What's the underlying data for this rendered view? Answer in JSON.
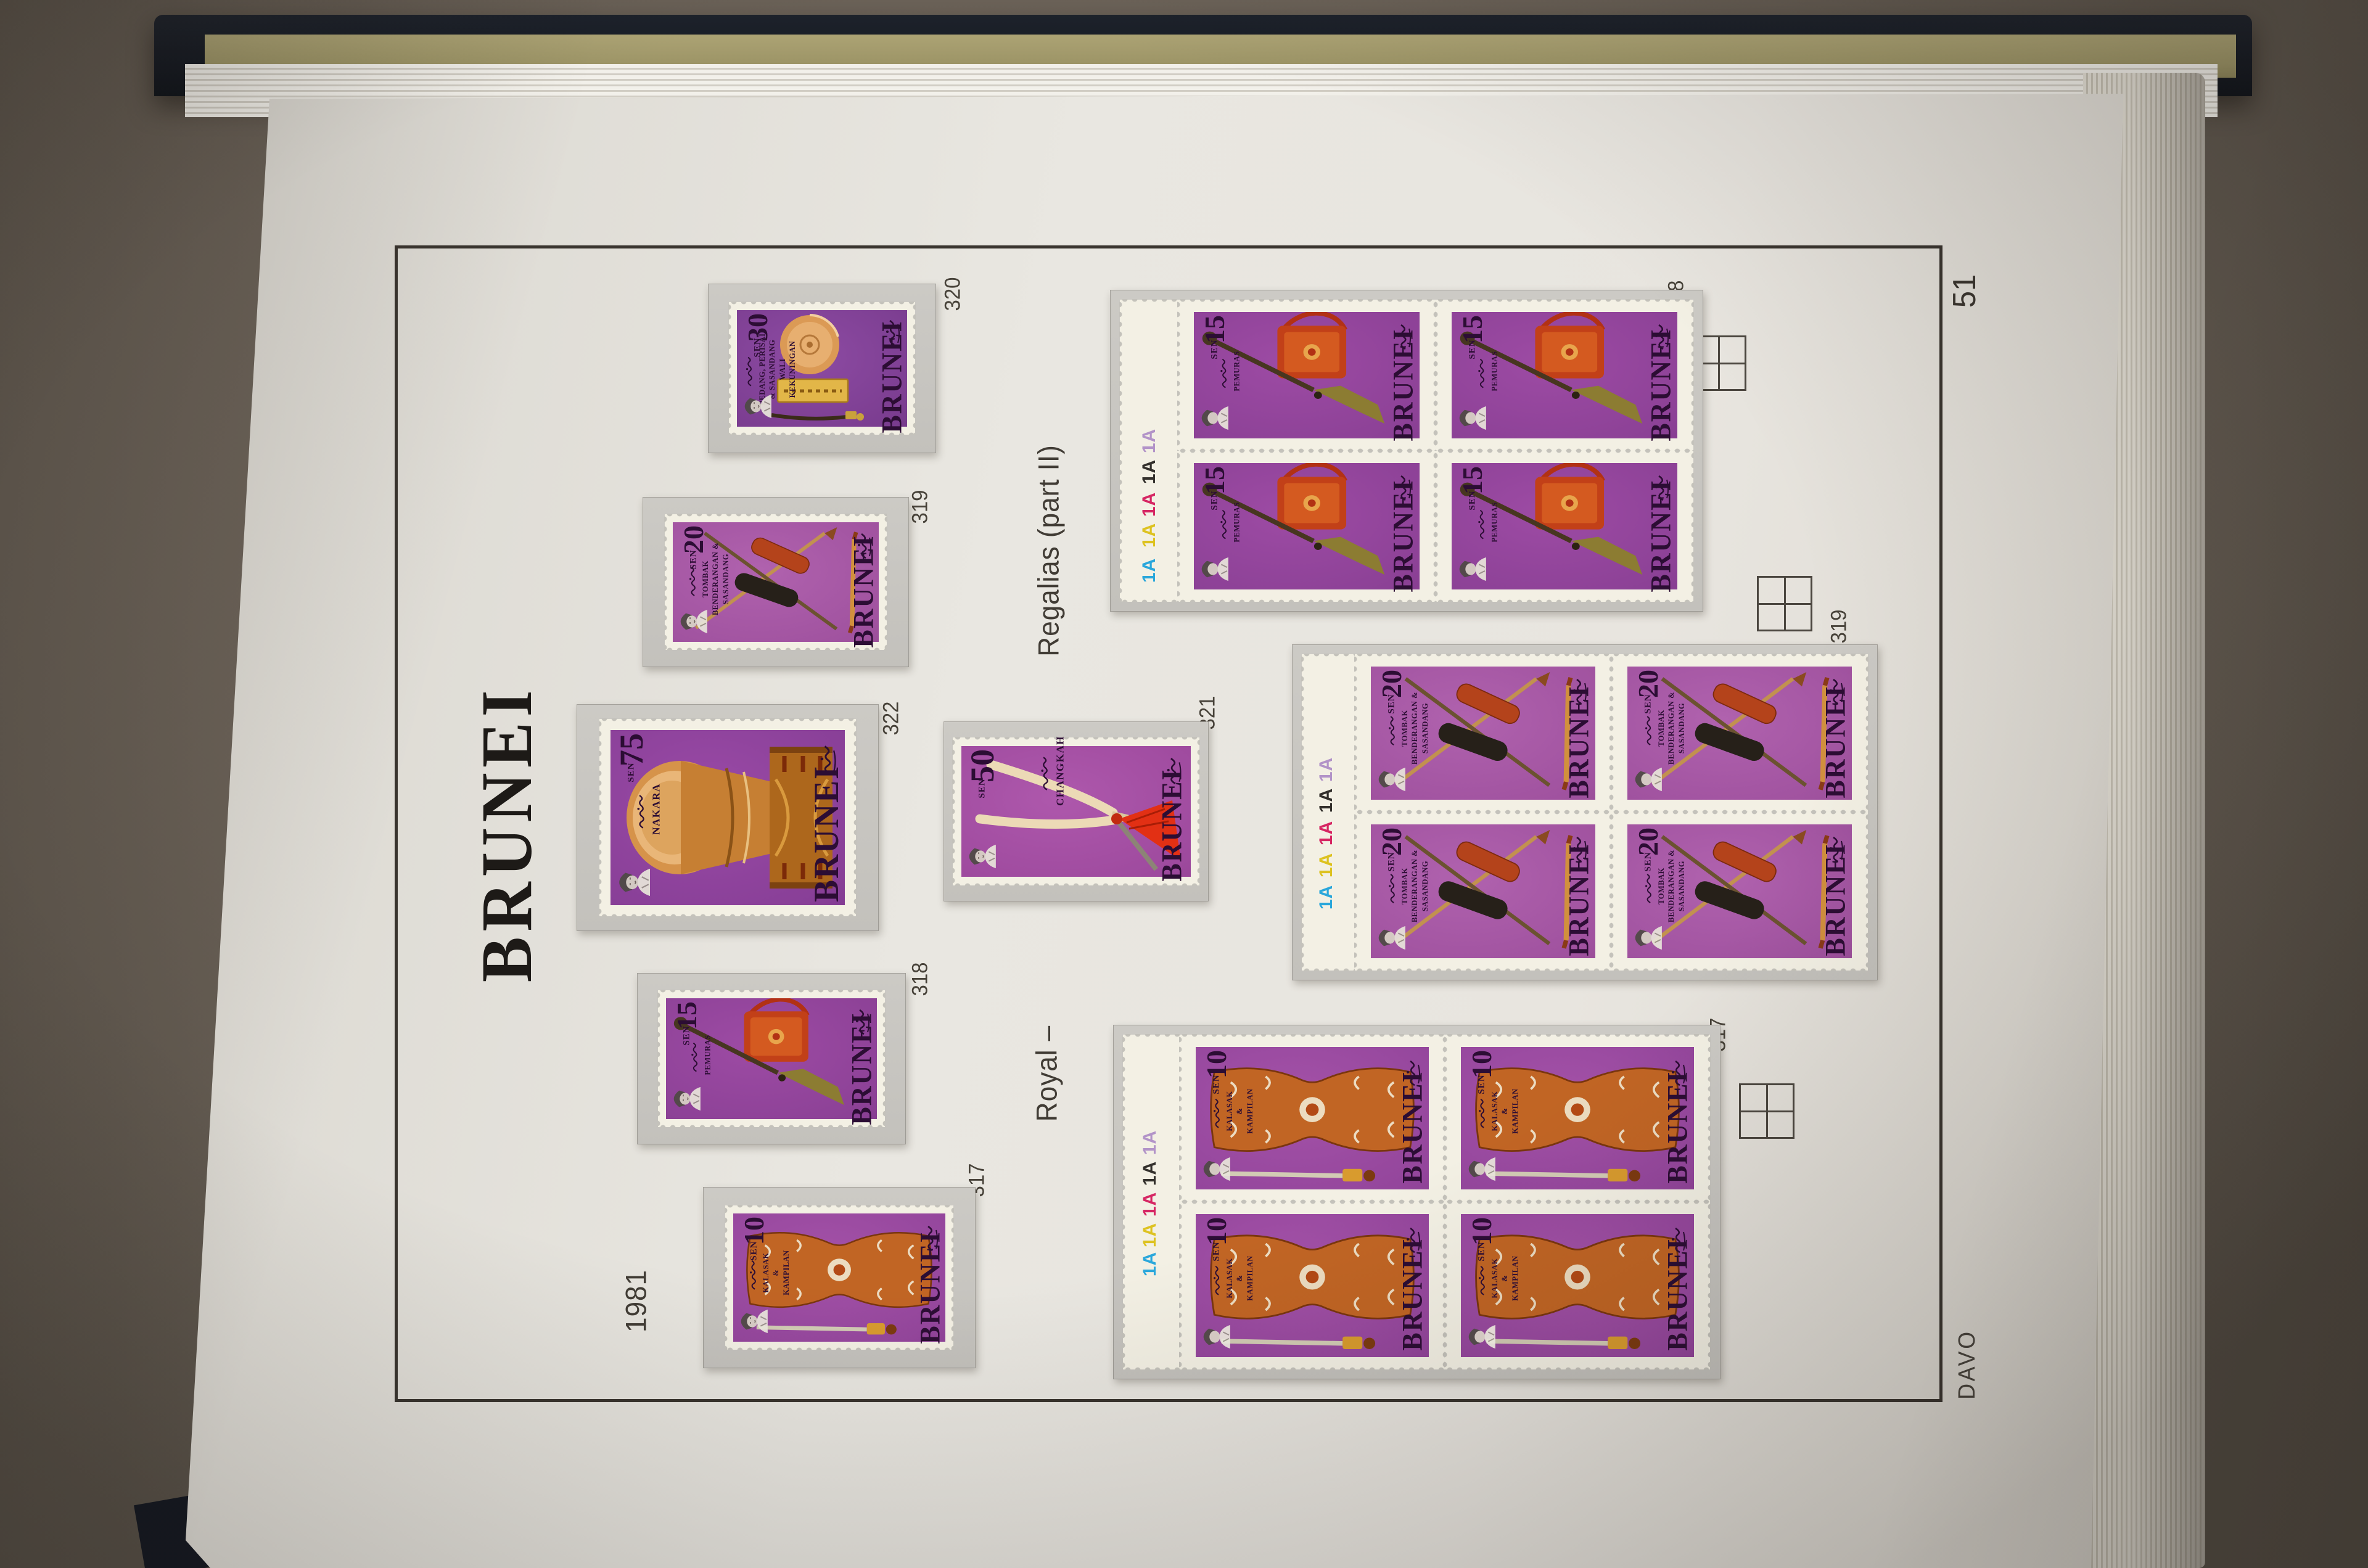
{
  "page": {
    "heading": "BRUNEI",
    "page_number": "51",
    "brand": "DAVO",
    "year": "1981",
    "series_caption_upper": "Regalias (part II)",
    "series_caption_lower": "Royal –"
  },
  "catalog_labels": {
    "s320": "320",
    "s319": "319",
    "s322": "322",
    "s321": "321",
    "s318": "318",
    "s317": "317",
    "b318": "318",
    "b319": "319",
    "b317": "317"
  },
  "stamps": {
    "s320": {
      "value": "30",
      "unit": "SEN",
      "country": "BRUNEI",
      "caption": [
        "PEDANG, PERISAI",
        "& SASANDANG",
        "WALI",
        "KEKUNINGAN"
      ]
    },
    "s319": {
      "value": "20",
      "unit": "SEN",
      "country": "BRUNEI",
      "caption": [
        "TOMBAK",
        "BENDERANGAN &",
        "SASANDANG"
      ]
    },
    "s322": {
      "value": "75",
      "unit": "SEN",
      "country": "BRUNEI",
      "caption": [
        "NAKARA"
      ]
    },
    "s321": {
      "value": "50",
      "unit": "SEN",
      "country": "BRUNEI",
      "caption": [
        "CHANGKAH"
      ]
    },
    "s318": {
      "value": "15",
      "unit": "SEN",
      "country": "BRUNEI",
      "caption": [
        "PEMURAS"
      ]
    },
    "s317": {
      "value": "10",
      "unit": "SEN",
      "country": "BRUNEI",
      "caption": [
        "KALASAK",
        "&",
        "KAMPILAN"
      ]
    }
  },
  "plate_marks": {
    "text": "1A",
    "colors": {
      "lilac": "#b293c8",
      "black": "#33302c",
      "magenta": "#d62663",
      "yellow": "#ddc220",
      "cyan": "#2aa7db"
    }
  },
  "colors": {
    "desk": "#6a6157",
    "album_cover": "#171b22",
    "divider_card": "#a29a6a",
    "page_paper": "#e9e6e0",
    "mount_gray": "#c7c5c0",
    "frame_line": "#39342e",
    "stamp_purple": "#8c4196",
    "stamp_cream": "#f3f0e4"
  }
}
